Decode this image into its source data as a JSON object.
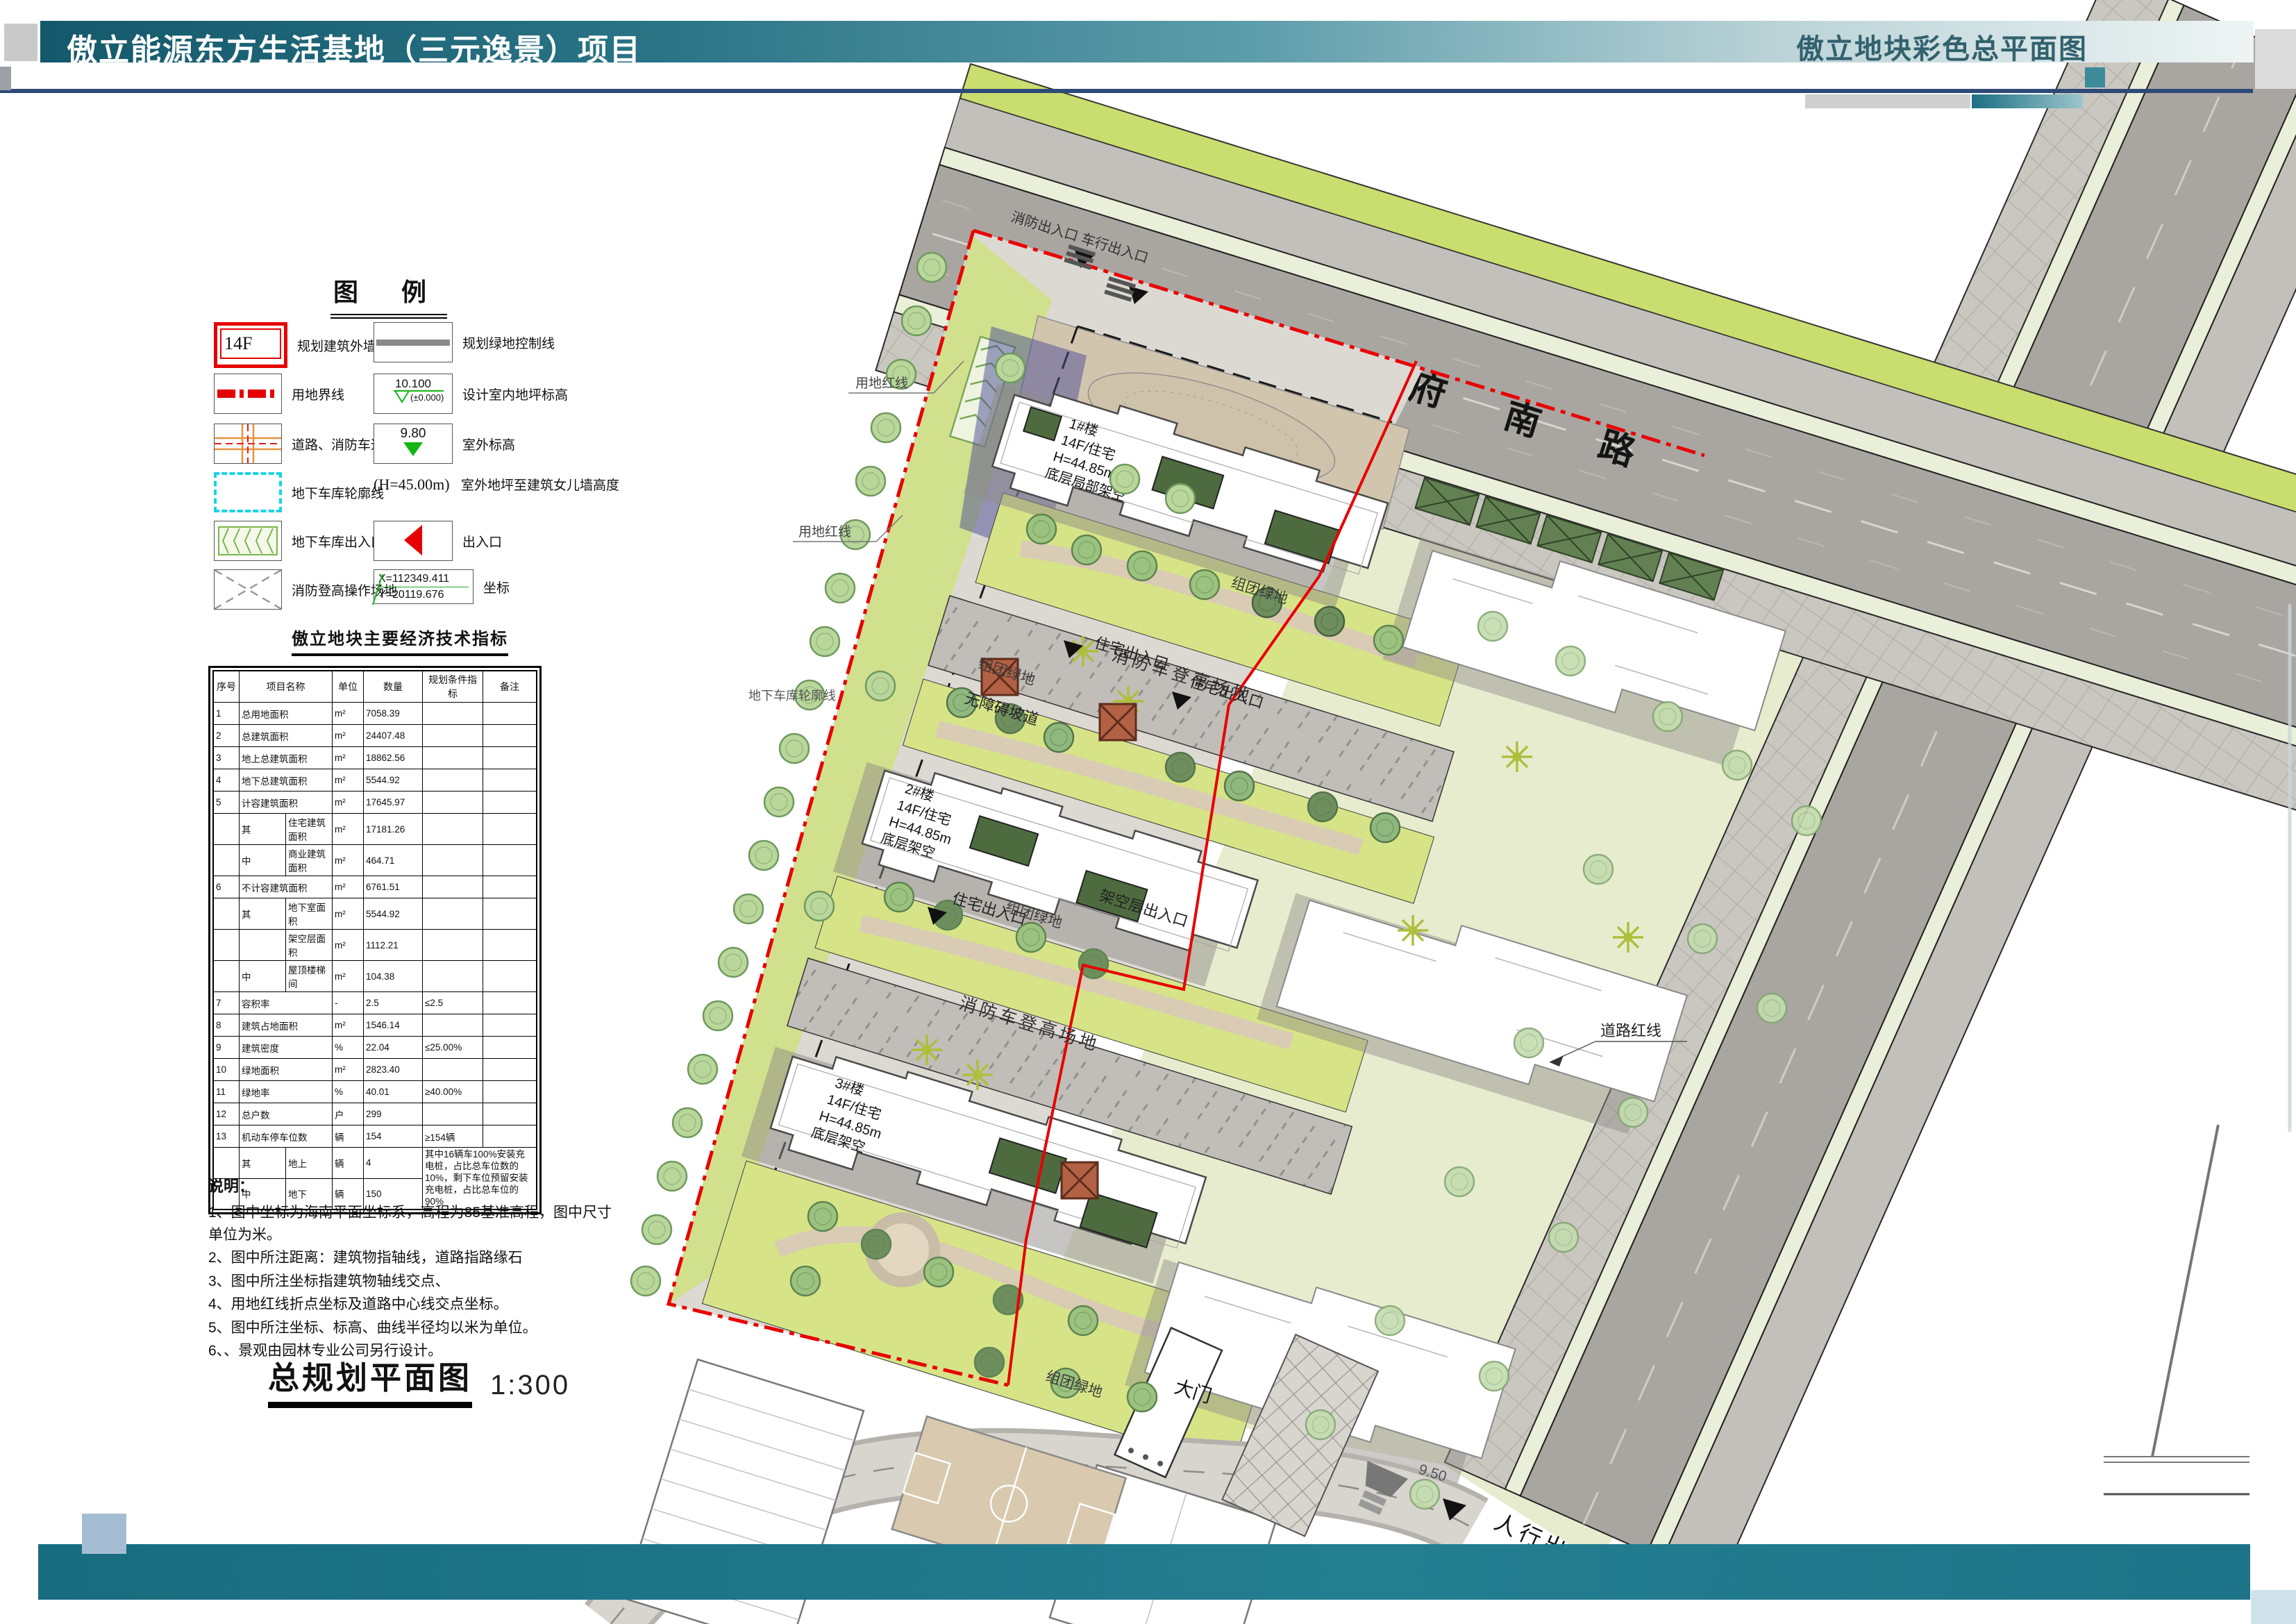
{
  "header": {
    "title": "傲立能源东方生活基地（三元逸景）项目",
    "right_title": "傲立地块彩色总平面图"
  },
  "legend": {
    "title": "图 例",
    "left": [
      {
        "id": "building-outline",
        "symbol_text": "14F",
        "label": "规划建筑外墙线及层数"
      },
      {
        "id": "land-boundary",
        "label": "用地界线"
      },
      {
        "id": "road-fire-lane",
        "label": "道路、消防车道"
      },
      {
        "id": "garage-outline",
        "label": "地下车库轮廓线"
      },
      {
        "id": "garage-entrance",
        "label": "地下车库出入口"
      },
      {
        "id": "fire-operation-area",
        "label": "消防登高操作场地"
      }
    ],
    "right": [
      {
        "id": "green-control-line",
        "label": "规划绿地控制线"
      },
      {
        "id": "indoor-elevation",
        "value_top": "10.100",
        "value_bottom": "(±0.000)",
        "label": "设计室内地坪标高"
      },
      {
        "id": "outdoor-elevation",
        "value": "9.80",
        "label": "室外标高"
      },
      {
        "id": "parapet-height",
        "value": "(H=45.00m)",
        "label": "室外地坪至建筑女儿墙高度"
      },
      {
        "id": "entrance",
        "label": "出入口"
      },
      {
        "id": "coordinate",
        "x": "X=112349.411",
        "y": "Y=20119.676",
        "label": "坐标"
      }
    ]
  },
  "indicators": {
    "title": "傲立地块主要经济技术指标",
    "headers": [
      "序号",
      "项目名称",
      "单位",
      "数量",
      "规划条件指标",
      "备注"
    ],
    "rows": [
      {
        "no": "1",
        "name": "总用地面积",
        "unit": "m²",
        "qty": "7058.39"
      },
      {
        "no": "2",
        "name": "总建筑面积",
        "unit": "m²",
        "qty": "24407.48"
      },
      {
        "no": "3",
        "name": "地上总建筑面积",
        "unit": "m²",
        "qty": "18862.56"
      },
      {
        "no": "4",
        "name": "地下总建筑面积",
        "unit": "m²",
        "qty": "5544.92"
      },
      {
        "no": "5",
        "name": "计容建筑面积",
        "unit": "m²",
        "qty": "17645.97"
      },
      {
        "sub": "其",
        "name": "住宅建筑面积",
        "unit": "m²",
        "qty": "17181.26"
      },
      {
        "sub": "中",
        "name": "商业建筑面积",
        "unit": "m²",
        "qty": "464.71"
      },
      {
        "no": "6",
        "name": "不计容建筑面积",
        "unit": "m²",
        "qty": "6761.51"
      },
      {
        "sub": "其",
        "name": "地下室面积",
        "unit": "m²",
        "qty": "5544.92"
      },
      {
        "sub": "",
        "name": "架空层面积",
        "unit": "m²",
        "qty": "1112.21"
      },
      {
        "sub": "中",
        "name": "屋顶楼梯间",
        "unit": "m²",
        "qty": "104.38"
      },
      {
        "no": "7",
        "name": "容积率",
        "unit": "-",
        "qty": "2.5",
        "cond": "≤2.5"
      },
      {
        "no": "8",
        "name": "建筑占地面积",
        "unit": "m²",
        "qty": "1546.14"
      },
      {
        "no": "9",
        "name": "建筑密度",
        "unit": "%",
        "qty": "22.04",
        "cond": "≤25.00%"
      },
      {
        "no": "10",
        "name": "绿地面积",
        "unit": "m²",
        "qty": "2823.40"
      },
      {
        "no": "11",
        "name": "绿地率",
        "unit": "%",
        "qty": "40.01",
        "cond": "≥40.00%"
      },
      {
        "no": "12",
        "name": "总户数",
        "unit": "户",
        "qty": "299"
      },
      {
        "no": "13",
        "name": "机动车停车位数",
        "unit": "辆",
        "qty": "154",
        "cond": "≥154辆"
      },
      {
        "sub": "其",
        "name": "地上",
        "unit": "辆",
        "qty": "4",
        "note": "其中16辆车100%安装充电桩，占比总车位数的10%，剩下车位预留安装充电桩，占比总车位的90%"
      },
      {
        "sub": "中",
        "name": "地下",
        "unit": "辆",
        "qty": "150"
      }
    ]
  },
  "notes": {
    "title": "说明：",
    "items": [
      "1、图中坐标为海南平面坐标系，高程为85基准高程，图中尺寸单位为米。",
      "2、图中所注距离：建筑物指轴线，道路指路缘石",
      "3、图中所注坐标指建筑物轴线交点、",
      "4、用地红线折点坐标及道路中心线交点坐标。",
      "5、图中所注坐标、标高、曲线半径均以米为单位。",
      "6、、景观由园林专业公司另行设计。"
    ]
  },
  "caption": {
    "title": "总规划平面图",
    "scale": "1:300"
  },
  "plan": {
    "road_name": "东 府 南 路",
    "buildings": {
      "b1": [
        "1#楼",
        "14F/住宅",
        "H=44.85m",
        "底层局部架空"
      ],
      "b2": [
        "2#楼",
        "14F/住宅",
        "H=44.85m",
        "底层架空"
      ],
      "b3": [
        "3#楼",
        "14F/住宅",
        "H=44.85m",
        "底层架空"
      ]
    },
    "labels": {
      "fire_lane": "消防车登高场地",
      "group_green": "组团绿地",
      "res_entrance": "住宅出入口",
      "stilt_entrance": "架空层出入口",
      "ramp": "无障碍坡道",
      "land_redline": "用地红线",
      "road_redline": "道路红线",
      "garage_outline": "地下车库轮廓线",
      "gate": "大门",
      "ped_entrance": "人行出入口",
      "fire_vehicle_entrance": "消防出入口 车行出入口",
      "elev": "9.50"
    }
  },
  "colors": {
    "header_teal": "#1e6f81",
    "accent_navy": "#2e4a78",
    "boundary_red": "#e60000",
    "lawn_green": "#d6e487",
    "road_gray": "#a9a6a1",
    "tree_green": "#b9d69b",
    "footer_teal": "#1d7488"
  }
}
